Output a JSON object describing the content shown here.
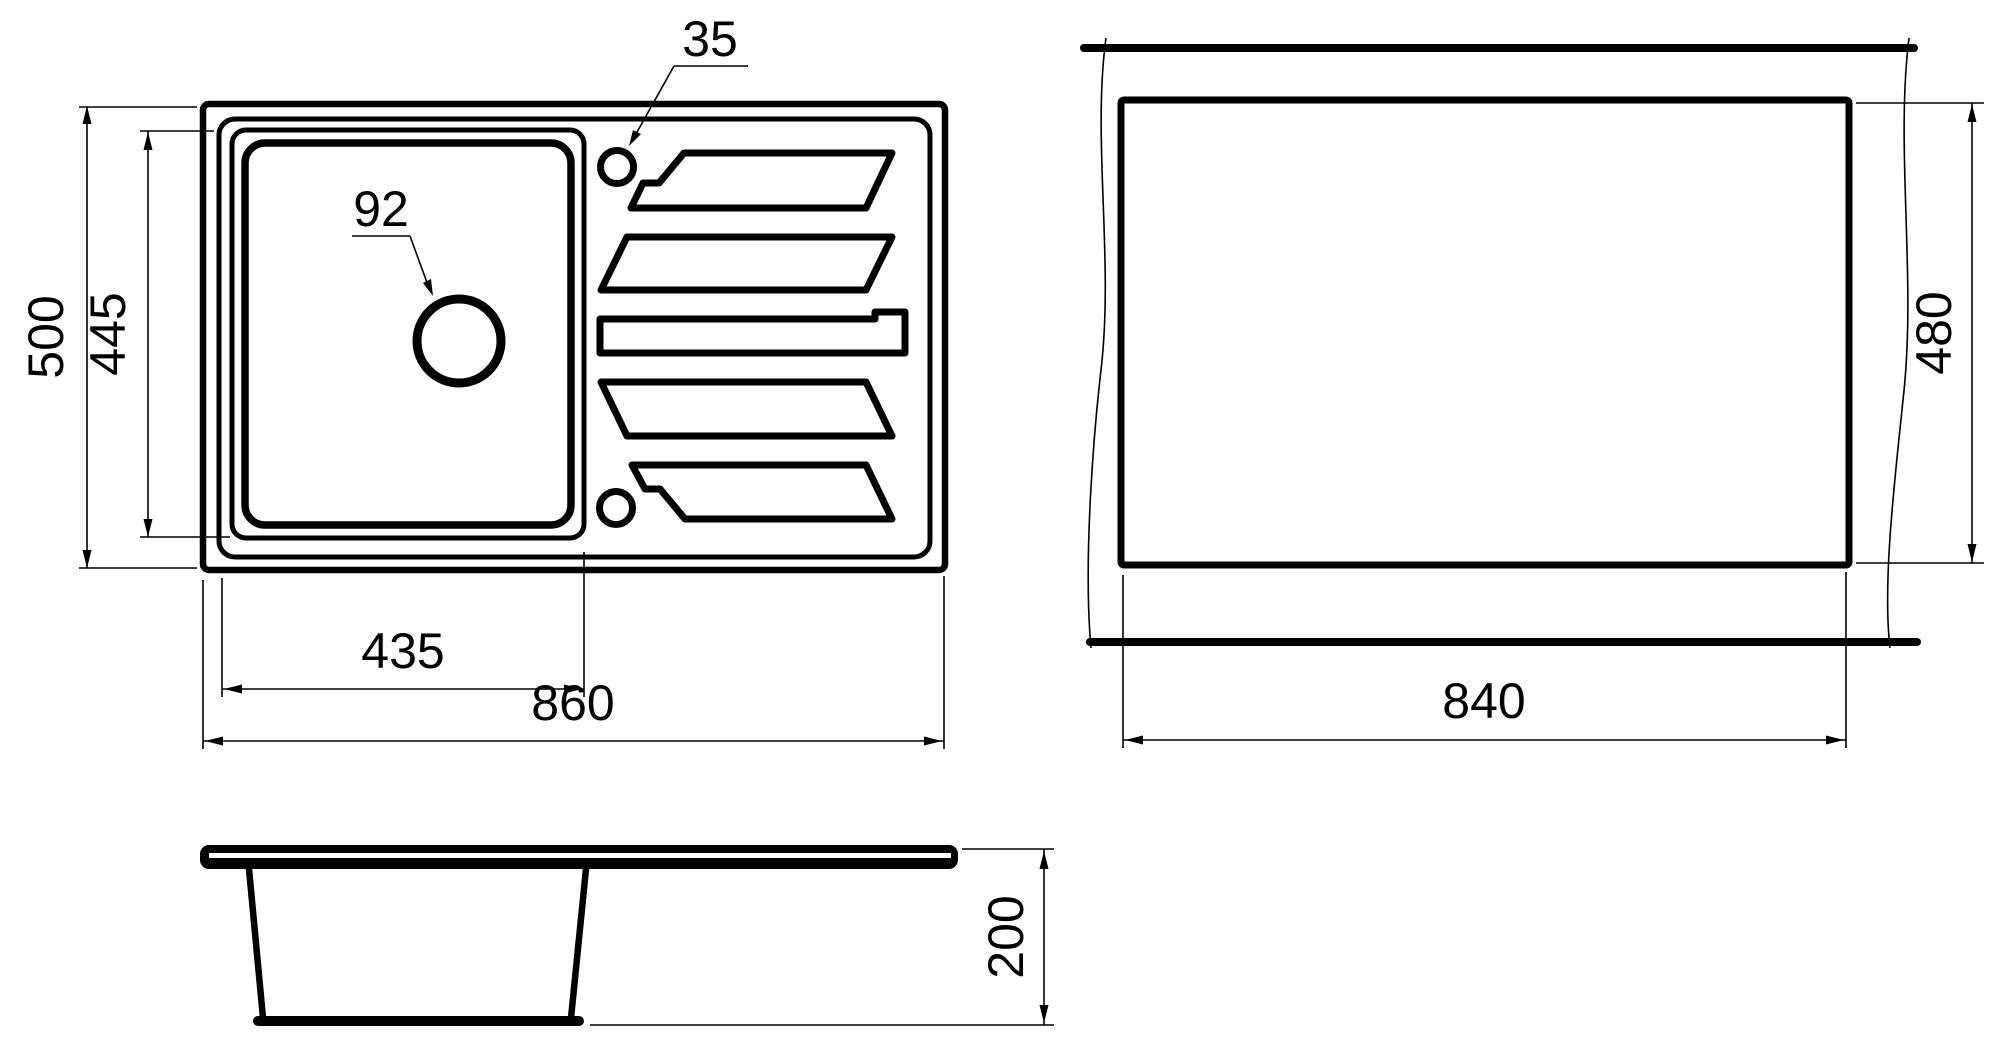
{
  "drawing": {
    "type": "technical dimension drawing",
    "product": "kitchen sink with single bowl and drainboard",
    "units": "mm"
  },
  "views": {
    "top": {
      "name": "top view"
    },
    "cutout": {
      "name": "countertop cutout view"
    },
    "section": {
      "name": "side section view"
    }
  },
  "dimensions": {
    "overall_width": "860",
    "overall_depth": "500",
    "basin_width": "435",
    "basin_inner_depth": "445",
    "drain_hole_diameter": "92",
    "tap_hole_diameter": "35",
    "cutout_width": "840",
    "cutout_depth": "480",
    "bowl_depth": "200"
  }
}
